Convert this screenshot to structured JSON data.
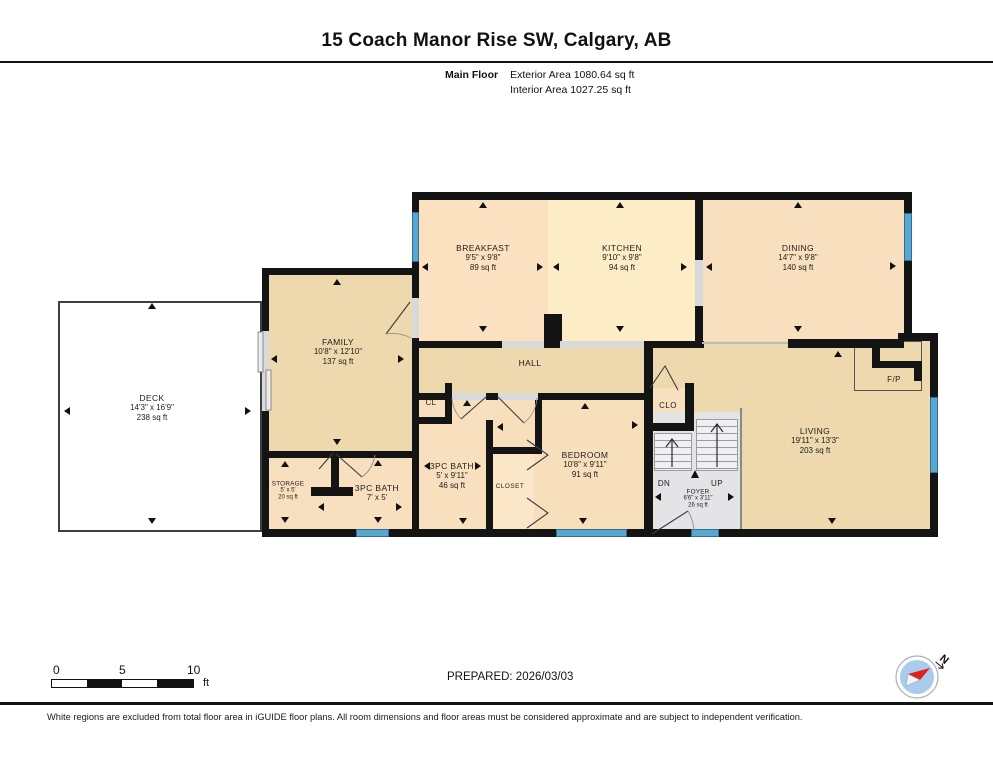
{
  "header": {
    "title": "15 Coach Manor Rise SW, Calgary, AB",
    "floor_label": "Main Floor",
    "exterior_area": "Exterior Area 1080.64 sq ft",
    "interior_area": "Interior Area 1027.25 sq ft"
  },
  "rooms": {
    "deck": {
      "name": "DECK",
      "dims": "14'3\" x 16'9\"",
      "area": "238 sq ft"
    },
    "family": {
      "name": "FAMILY",
      "dims": "10'8\" x 12'10\"",
      "area": "137 sq ft"
    },
    "breakfast": {
      "name": "BREAKFAST",
      "dims": "9'5\" x 9'8\"",
      "area": "89 sq ft"
    },
    "kitchen": {
      "name": "KITCHEN",
      "dims": "9'10\" x 9'8\"",
      "area": "94 sq ft"
    },
    "dining": {
      "name": "DINING",
      "dims": "14'7\" x 9'8\"",
      "area": "140 sq ft"
    },
    "hall": {
      "name": "HALL"
    },
    "living": {
      "name": "LIVING",
      "dims": "19'11\" x 13'3\"",
      "area": "203 sq ft"
    },
    "fireplace": {
      "name": "F/P"
    },
    "cl": {
      "name": "CL"
    },
    "clo": {
      "name": "CLO"
    },
    "bath_5": {
      "name": "3PC BATH",
      "dims": "5' x 9'11\"",
      "area": "46 sq ft"
    },
    "closet": {
      "name": "CLOSET"
    },
    "bedroom": {
      "name": "BEDROOM",
      "dims": "10'8\" x 9'11\"",
      "area": "91 sq ft"
    },
    "storage": {
      "name": "STORAGE",
      "dims": "5' x 5'",
      "area": "20 sq ft"
    },
    "bath_7": {
      "name": "3PC BATH",
      "dims": "7' x 5'"
    },
    "foyer": {
      "name": "FOYER",
      "dims": "6'6\" x 3'11\"",
      "area": "26 sq ft"
    },
    "stairs": {
      "down_label": "DN",
      "up_label": "UP"
    }
  },
  "footer": {
    "scale": {
      "tick_0": "0",
      "tick_5": "5",
      "tick_10": "10",
      "unit": "ft"
    },
    "prepared": "PREPARED: 2026/03/03",
    "compass_label": "N",
    "disclaimer": "White regions are excluded from total floor area in iGUIDE floor plans. All room dimensions and floor areas must be considered approximate and are subject to independent verification."
  },
  "colors": {
    "wall": "#141414",
    "window_blue": "#58a7d0",
    "room_tan": "#eed9ae",
    "room_peach": "#f8e0bf",
    "room_breakfast": "#fbe1c0",
    "room_kitchen": "#fcedc6",
    "closet_light": "#fbe6c8",
    "stairs_gray": "#e4e4e7",
    "opening_gray": "#d9d9d9",
    "deck_white": "#ffffff"
  }
}
